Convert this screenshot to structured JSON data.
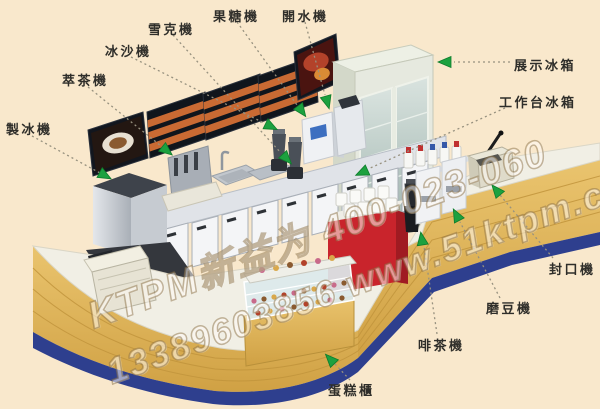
{
  "diagram": {
    "type": "beverage-shop-equipment-layout",
    "background_color": "#F9E8CC"
  },
  "labels": [
    {
      "id": "ice-maker",
      "text": "製冰機"
    },
    {
      "id": "tea-extractor",
      "text": "萃茶機"
    },
    {
      "id": "smoothie-machine",
      "text": "冰沙機"
    },
    {
      "id": "shaker-machine",
      "text": "雪克機"
    },
    {
      "id": "fructose-machine",
      "text": "果糖機"
    },
    {
      "id": "water-boiler",
      "text": "開水機"
    },
    {
      "id": "display-fridge",
      "text": "展示冰箱"
    },
    {
      "id": "worktable-fridge",
      "text": "工作台冰箱"
    },
    {
      "id": "sealing-machine",
      "text": "封口機"
    },
    {
      "id": "bean-grinder",
      "text": "磨豆機"
    },
    {
      "id": "coffee-tea-machine",
      "text": "啡茶機"
    },
    {
      "id": "cake-display",
      "text": "蛋糕櫃"
    }
  ],
  "watermark": {
    "line1": "KTPM新益为 400-023-060",
    "line2": "13389603856 www.51ktpm.com"
  },
  "colors": {
    "arrow_green": "#1CA13F",
    "counter_gold": "#E2B75A",
    "counter_base_blue": "#2E3F8E",
    "cup_holder_red": "#C9242C",
    "background_cream": "#F9E8CC"
  }
}
